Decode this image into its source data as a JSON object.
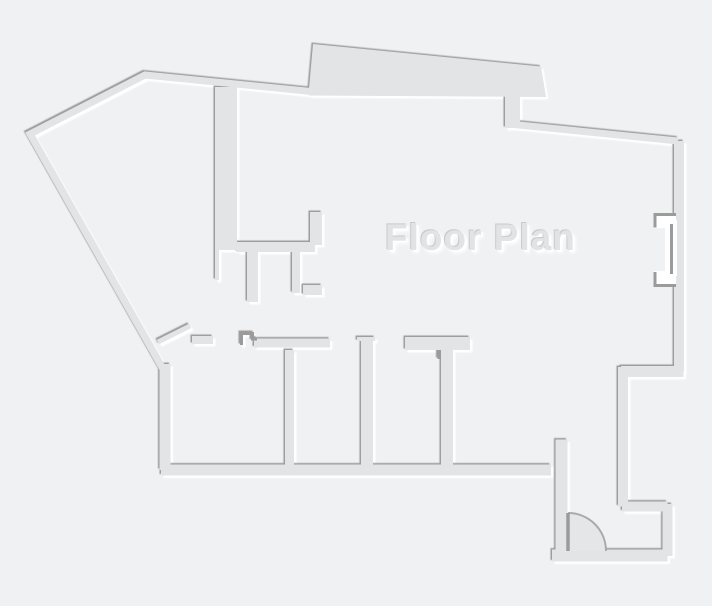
{
  "title": "Floor Plan",
  "canvas": {
    "width": 712,
    "height": 606
  },
  "palette": {
    "background": "#f0f1f2",
    "wall": "#e2e4e5",
    "edge_dark": "#9b9b9b",
    "edge_light": "#ffffff",
    "door_fill": "#e5e6e7",
    "door_arc": "#a8aaab",
    "text_fill": "#e2e3e4",
    "text_shadow_dark": "#c9cacb"
  },
  "walls": [
    {
      "name": "outer-wall-left-and-top",
      "type": "polyline",
      "points": [
        [
          163,
          369
        ],
        [
          30,
          134
        ],
        [
          145,
          75
        ],
        [
          311,
          91.5
        ]
      ],
      "width": 7
    },
    {
      "name": "top-bump-wall",
      "type": "polygon",
      "points": [
        [
          309,
          95.5
        ],
        [
          309,
          88.5
        ],
        [
          313,
          44
        ],
        [
          541,
          66.5
        ],
        [
          546,
          97
        ]
      ]
    },
    {
      "name": "bump-connector-wall",
      "type": "rect",
      "rect": [
        505,
        94,
        15,
        34
      ]
    },
    {
      "name": "top-right-sloped-wall",
      "type": "polyline",
      "points": [
        [
          509,
          124
        ],
        [
          678,
          141
        ]
      ],
      "width": 7
    },
    {
      "name": "right-wall",
      "type": "polyline",
      "points": [
        [
          679,
          141
        ],
        [
          679,
          371.5
        ]
      ],
      "width": 10
    },
    {
      "name": "right-step-wall",
      "type": "polyline",
      "points": [
        [
          683.5,
          371.5
        ],
        [
          621,
          371.5
        ]
      ],
      "width": 11
    },
    {
      "name": "right-lower-wall",
      "type": "polyline",
      "points": [
        [
          623,
          367
        ],
        [
          623,
          506.5
        ]
      ],
      "width": 10
    },
    {
      "name": "closet-top-wall",
      "type": "polyline",
      "points": [
        [
          622,
          506.5
        ],
        [
          667.5,
          506.5
        ]
      ],
      "width": 10
    },
    {
      "name": "closet-right-wall",
      "type": "polyline",
      "points": [
        [
          667.5,
          504
        ],
        [
          667.5,
          556
        ]
      ],
      "width": 10
    },
    {
      "name": "bottom-right-wall",
      "type": "polyline",
      "points": [
        [
          552,
          555.5
        ],
        [
          667.5,
          555.5
        ]
      ],
      "width": 12
    },
    {
      "name": "entry-left-wall",
      "type": "polyline",
      "points": [
        [
          561.5,
          439.5
        ],
        [
          561.5,
          556
        ]
      ],
      "width": 12
    },
    {
      "name": "left-wall-vertical",
      "type": "polyline",
      "points": [
        [
          165,
          364
        ],
        [
          165,
          470
        ]
      ],
      "width": 11
    },
    {
      "name": "bottom-wall",
      "type": "polyline",
      "points": [
        [
          161,
          470
        ],
        [
          551,
          470
        ]
      ],
      "width": 11
    },
    {
      "name": "room-wall-stub",
      "type": "polyline",
      "points": [
        [
          192,
          340
        ],
        [
          213,
          340
        ]
      ],
      "width": 8
    },
    {
      "name": "room-top-wall",
      "type": "polyline",
      "points": [
        [
          254,
          343
        ],
        [
          330,
          343
        ]
      ],
      "width": 9
    },
    {
      "name": "door-leaf-left",
      "type": "polyline",
      "points": [
        [
          158,
          342
        ],
        [
          190,
          326
        ]
      ],
      "width": 5
    },
    {
      "name": "door-step-detail",
      "type": "polyline",
      "points": [
        [
          241.5,
          345
        ],
        [
          241.5,
          333.5
        ],
        [
          252.5,
          333.5
        ],
        [
          252.5,
          339
        ],
        [
          257,
          339
        ]
      ],
      "width": 3,
      "color": "edge_dark"
    },
    {
      "name": "interior-thick-wall",
      "type": "rect",
      "rect": [
        215,
        87,
        22,
        163
      ]
    },
    {
      "name": "interior-wall-stub",
      "type": "polyline",
      "points": [
        [
          217,
          250
        ],
        [
          217,
          280
        ]
      ],
      "width": 4
    },
    {
      "name": "upper-room-top-wall",
      "type": "rect",
      "rect": [
        237,
        242,
        78,
        10
      ]
    },
    {
      "name": "upper-room-stub-up",
      "type": "rect",
      "rect": [
        310,
        212,
        12,
        33
      ]
    },
    {
      "name": "upper-room-stub-a",
      "type": "rect",
      "rect": [
        247,
        252,
        11,
        50
      ]
    },
    {
      "name": "upper-room-wall-b",
      "type": "rect",
      "rect": [
        292,
        252,
        8,
        41
      ]
    },
    {
      "name": "upper-room-stub-l",
      "type": "rect",
      "rect": [
        303,
        285,
        19,
        10
      ]
    },
    {
      "name": "partition-left",
      "type": "rect",
      "rect": [
        285,
        350,
        9,
        116
      ]
    },
    {
      "name": "partition-mid-cap",
      "type": "rect",
      "rect": [
        357,
        337,
        18,
        4
      ]
    },
    {
      "name": "partition-mid",
      "type": "rect",
      "rect": [
        361,
        340,
        12,
        127
      ]
    },
    {
      "name": "partition-right-bar",
      "type": "rect",
      "rect": [
        405,
        337,
        65,
        13
      ]
    },
    {
      "name": "partition-right",
      "type": "rect",
      "rect": [
        441,
        350,
        12,
        117
      ]
    },
    {
      "name": "partition-right-tick",
      "type": "polyline",
      "points": [
        [
          439,
          350
        ],
        [
          439,
          359
        ]
      ],
      "width": 3,
      "color": "edge_dark"
    }
  ],
  "overlays": [
    {
      "name": "window-notch",
      "type": "rect",
      "rect": [
        665,
        220,
        12,
        56
      ],
      "color": "edge_light"
    },
    {
      "name": "window-jamb-top-bg",
      "type": "rect",
      "rect": [
        654,
        215,
        22,
        13
      ],
      "color": "edge_light"
    },
    {
      "name": "window-jamb-bottom-bg",
      "type": "rect",
      "rect": [
        654,
        271,
        22,
        16
      ],
      "color": "edge_light"
    },
    {
      "name": "window-jamb-top",
      "type": "polyline",
      "points": [
        [
          676,
          214.5
        ],
        [
          655,
          214.5
        ],
        [
          655,
          227.5
        ]
      ],
      "width": 3,
      "color": "edge_dark"
    },
    {
      "name": "window-pane",
      "type": "polyline",
      "points": [
        [
          671.5,
          224
        ],
        [
          671.5,
          274
        ]
      ],
      "width": 3,
      "color": "edge_dark"
    },
    {
      "name": "window-jamb-bottom",
      "type": "polyline",
      "points": [
        [
          655,
          272
        ],
        [
          655,
          285.5
        ],
        [
          676,
          285.5
        ]
      ],
      "width": 3,
      "color": "edge_dark"
    }
  ],
  "door": {
    "name": "entry-door-swing",
    "hinge": [
      568,
      551
    ],
    "radius": 38
  }
}
